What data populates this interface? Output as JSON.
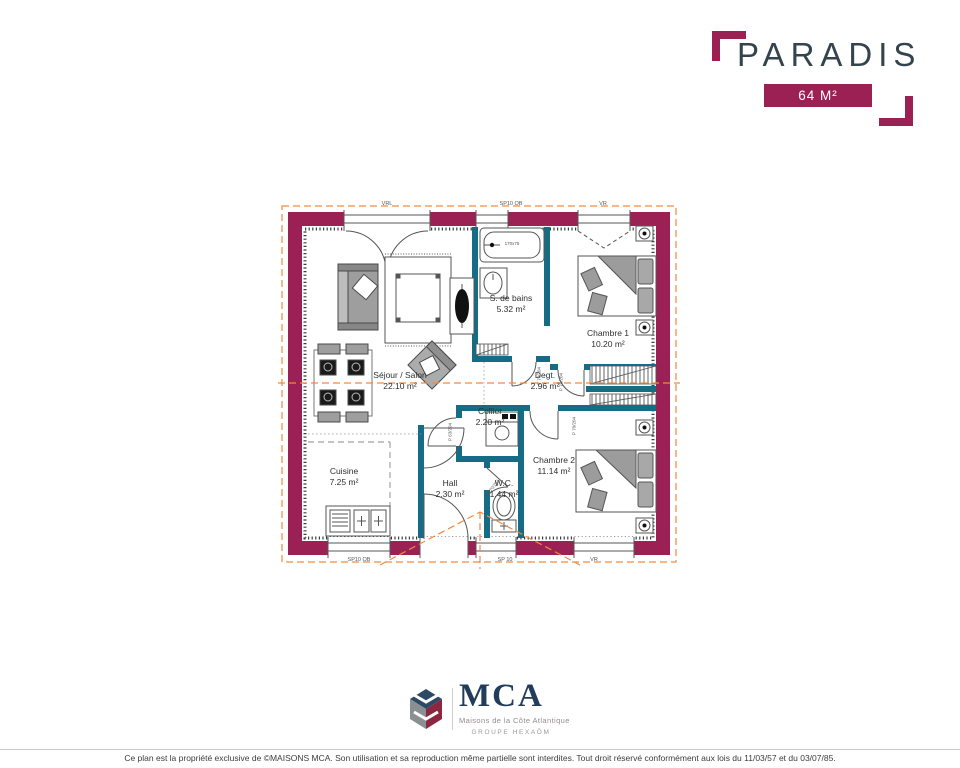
{
  "header": {
    "title": "PARADIS",
    "area_badge": "64 M²"
  },
  "plan": {
    "rooms": [
      {
        "name": "S. de bains",
        "area": "5.32 m²"
      },
      {
        "name": "Chambre 1",
        "area": "10.20 m²"
      },
      {
        "name": "Séjour / Salon",
        "area": "22.10 m²"
      },
      {
        "name": "Degt.",
        "area": "2.96 m²"
      },
      {
        "name": "Cellier",
        "area": "2.20 m²"
      },
      {
        "name": "Cuisine",
        "area": "7.25 m²"
      },
      {
        "name": "Hall",
        "area": "2.30 m²"
      },
      {
        "name": "W.C.",
        "area": "1.44 m²"
      },
      {
        "name": "Chambre 2",
        "area": "11.14 m²"
      }
    ],
    "opening_labels": {
      "top_left": "VRL",
      "top_center": "SP10 OB",
      "top_right": "VR",
      "bottom_left": "SP10 OB",
      "bottom_center": "SP 10",
      "bottom_right": "VR"
    },
    "door_labels": {
      "d63": "P 63/204",
      "d70": "P 70/204"
    },
    "fixtures": {
      "bathtub_size": "170x75"
    },
    "colors": {
      "exterior_wall": "#9b2154",
      "interior_wall": "#166b85",
      "roof_line": "#f08a3c"
    }
  },
  "logo": {
    "acronym": "MCA",
    "tagline": "Maisons de la Côte Atlantique",
    "group": "GROUPE HEXAŌM"
  },
  "footer": {
    "disclaimer": "Ce plan est la propriété exclusive de ©MAISONS MCA. Son utilisation et sa reproduction même partielle sont interdites. Tout droit réservé conformément aux lois du 11/03/57 et du 03/07/85."
  }
}
